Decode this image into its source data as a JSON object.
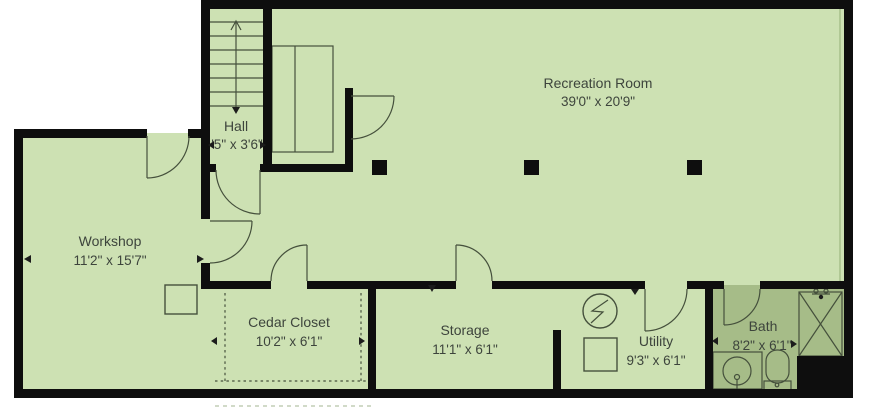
{
  "floorplan": {
    "rooms": [
      {
        "name": "Recreation Room",
        "dims": "39'0\" x 20'9\""
      },
      {
        "name": "Hall",
        "dims": "'5\" x 3'6\""
      },
      {
        "name": "Workshop",
        "dims": "11'2\" x 15'7\""
      },
      {
        "name": "Cedar Closet",
        "dims": "10'2\" x 6'1\""
      },
      {
        "name": "Storage",
        "dims": "11'1\" x 6'1\""
      },
      {
        "name": "Utility",
        "dims": "9'3\" x 6'1\""
      },
      {
        "name": "Bath",
        "dims": "8'2\" x 6'1\""
      }
    ],
    "fixtures": [
      "stairs-up",
      "electrical-panel",
      "utility-box",
      "sink",
      "toilet",
      "shower",
      "support-columns",
      "door-swings",
      "cedar-closet-lining"
    ],
    "colors": {
      "floor": "#cde1b3",
      "bath_floor": "#a6bc88",
      "wall": "#0e0e0e",
      "linework": "#45503c",
      "text": "#3d443c",
      "background": "#ffffff"
    }
  }
}
